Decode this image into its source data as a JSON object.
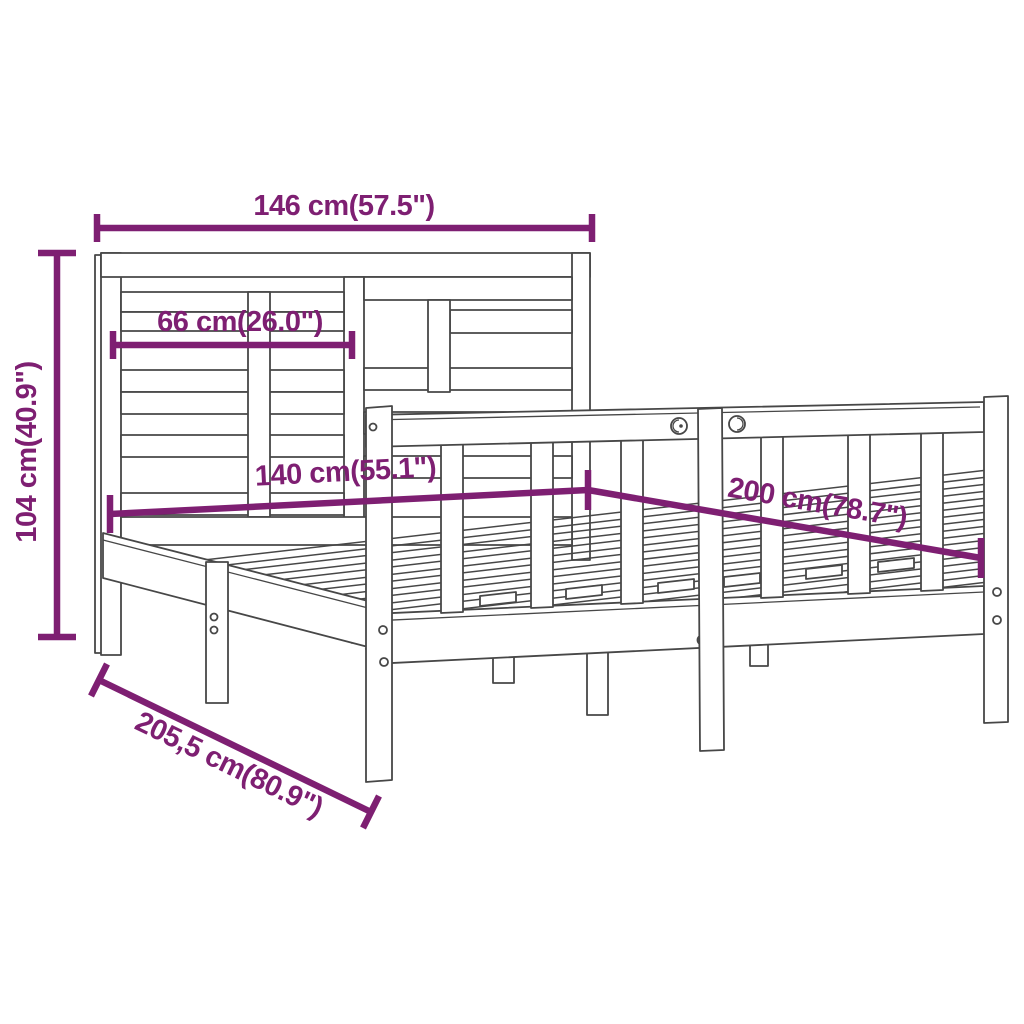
{
  "diagram": {
    "subject": "Wooden bed frame with headboard - product dimension diagram",
    "colors": {
      "dimension": "#7E1F72",
      "line": "#474747",
      "background": "#FFFFFF"
    },
    "dimensions": {
      "headboard_width": {
        "label": "146 cm(57.5\")",
        "cm": "146",
        "inch": "57.5"
      },
      "panel_width": {
        "label": "66 cm(26.0\")",
        "cm": "66",
        "inch": "26.0"
      },
      "headboard_height": {
        "label": "104 cm(40.9\")",
        "cm": "104",
        "inch": "40.9"
      },
      "bed_width": {
        "label": "140 cm(55.1\")",
        "cm": "140",
        "inch": "55.1"
      },
      "bed_length": {
        "label": "200 cm(78.7\")",
        "cm": "200",
        "inch": "78.7"
      },
      "total_length": {
        "label": "205,5 cm(80.9\")",
        "cm": "205,5",
        "inch": "80.9"
      }
    }
  }
}
